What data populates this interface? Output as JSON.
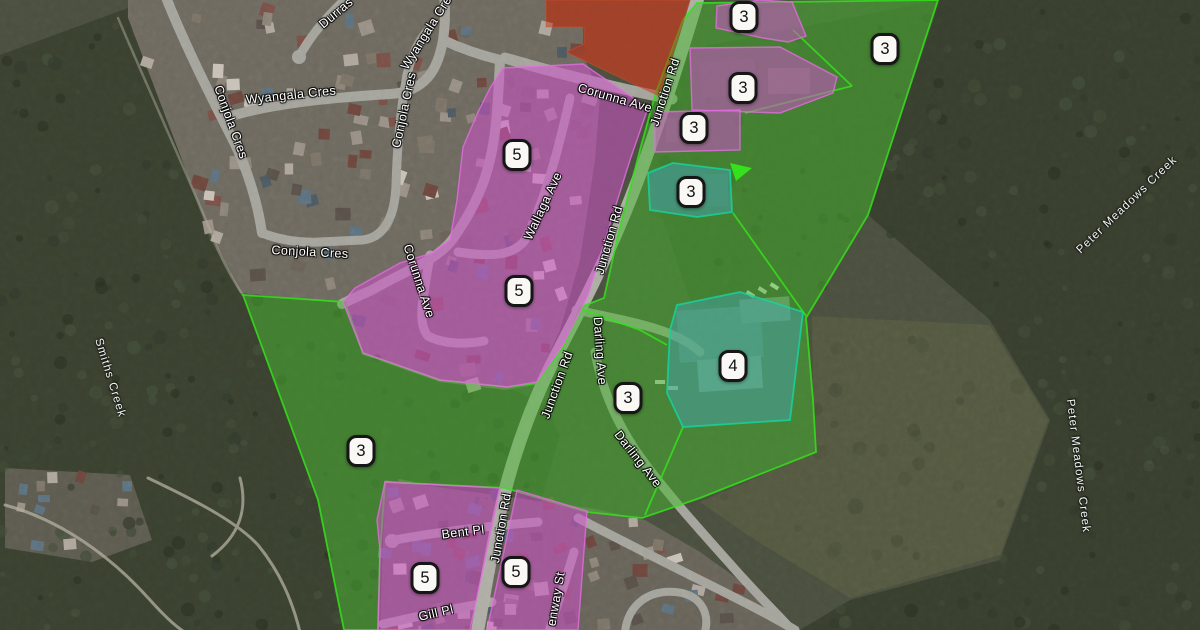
{
  "map": {
    "description": "Satellite zoning map with colored planning overlay zones and numbered zone markers",
    "street_labels": [
      {
        "text": "Durras",
        "x": 336,
        "y": 13,
        "rot": -40
      },
      {
        "text": "Wyangala Cres",
        "x": 428,
        "y": 30,
        "rot": -58
      },
      {
        "text": "Wyangala Cres",
        "x": 291,
        "y": 95,
        "rot": -6
      },
      {
        "text": "Conjola Cres",
        "x": 231,
        "y": 122,
        "rot": 70
      },
      {
        "text": "Conjola Cres",
        "x": 310,
        "y": 252,
        "rot": 3
      },
      {
        "text": "Conjola Cres",
        "x": 404,
        "y": 110,
        "rot": -78
      },
      {
        "text": "Corunna Ave",
        "x": 615,
        "y": 98,
        "rot": 16
      },
      {
        "text": "Corunna Ave",
        "x": 419,
        "y": 281,
        "rot": 72
      },
      {
        "text": "Wallaga Ave",
        "x": 543,
        "y": 206,
        "rot": -65
      },
      {
        "text": "Junction Rd",
        "x": 665,
        "y": 92,
        "rot": -72
      },
      {
        "text": "Junction Rd",
        "x": 609,
        "y": 240,
        "rot": -74
      },
      {
        "text": "Junction Rd",
        "x": 557,
        "y": 385,
        "rot": -70
      },
      {
        "text": "Junction Rd",
        "x": 501,
        "y": 528,
        "rot": -80
      },
      {
        "text": "Darling Ave",
        "x": 600,
        "y": 351,
        "rot": 86
      },
      {
        "text": "Darling Ave",
        "x": 638,
        "y": 459,
        "rot": 52
      },
      {
        "text": "Bent Pl",
        "x": 463,
        "y": 532,
        "rot": -7
      },
      {
        "text": "Gill Pl",
        "x": 436,
        "y": 613,
        "rot": -13
      },
      {
        "text": "enway St",
        "x": 556,
        "y": 599,
        "rot": -80
      }
    ],
    "water_labels": [
      {
        "text": "Smiths Creek",
        "x": 110,
        "y": 378,
        "rot": 73
      },
      {
        "text": "Peter Meadows Creek",
        "x": 1127,
        "y": 205,
        "rot": -44
      },
      {
        "text": "Peter Meadows Creek",
        "x": 1078,
        "y": 466,
        "rot": 83
      }
    ],
    "markers": [
      {
        "value": "3",
        "x": 744,
        "y": 17
      },
      {
        "value": "3",
        "x": 885,
        "y": 49
      },
      {
        "value": "3",
        "x": 743,
        "y": 88
      },
      {
        "value": "3",
        "x": 694,
        "y": 128
      },
      {
        "value": "3",
        "x": 691,
        "y": 192
      },
      {
        "value": "5",
        "x": 517,
        "y": 155
      },
      {
        "value": "5",
        "x": 519,
        "y": 291
      },
      {
        "value": "4",
        "x": 733,
        "y": 366
      },
      {
        "value": "3",
        "x": 628,
        "y": 398
      },
      {
        "value": "3",
        "x": 361,
        "y": 451
      },
      {
        "value": "5",
        "x": 425,
        "y": 578
      },
      {
        "value": "5",
        "x": 516,
        "y": 572
      }
    ],
    "zone_colors": {
      "green": "#46b82e",
      "magenta": "#cf52cb",
      "teal": "#47a3ad",
      "red": "#c03a20",
      "green_border": "#35e01c",
      "magenta_border": "#e36ee0",
      "teal_border": "#15d39c"
    }
  }
}
